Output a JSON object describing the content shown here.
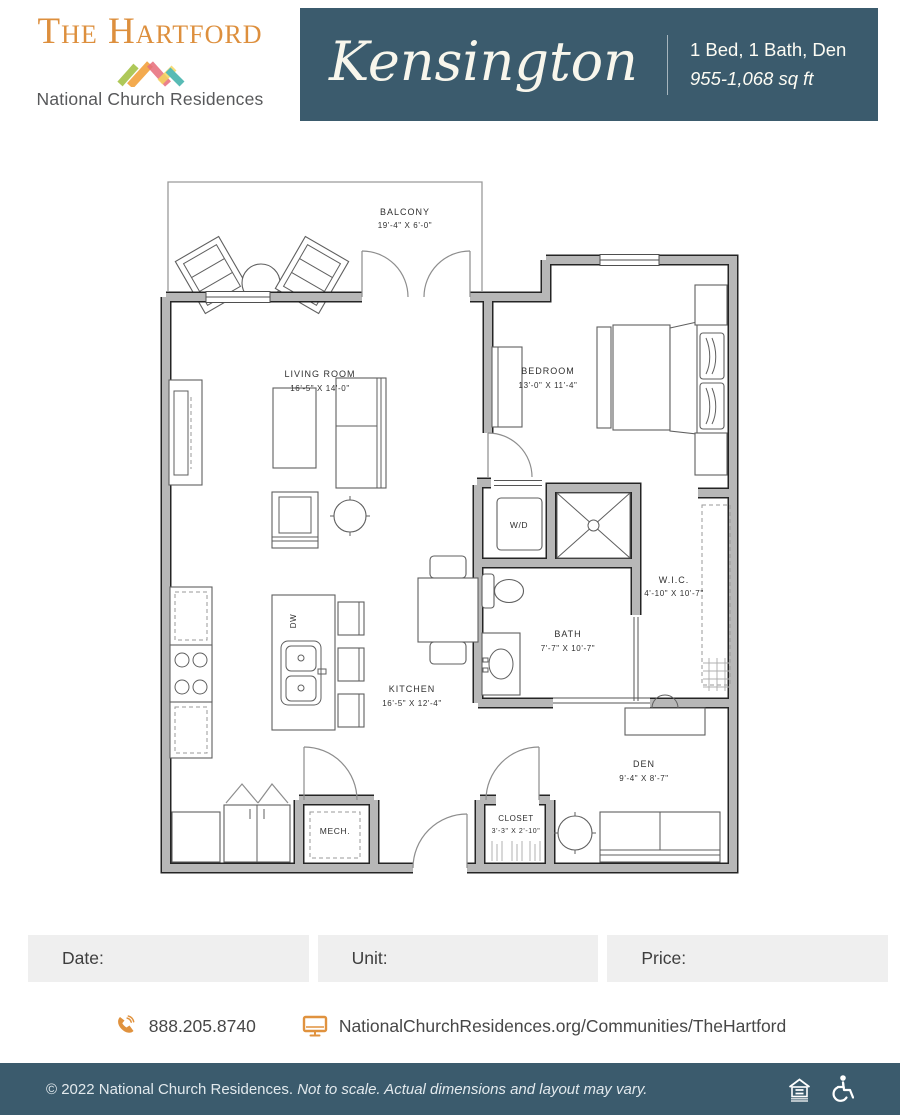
{
  "brand": {
    "name": "The Hartford",
    "org": "National Church Residences"
  },
  "plan": {
    "name": "Kensington",
    "type": "1 Bed, 1 Bath, Den",
    "sqft": "955-1,068 sq ft"
  },
  "floorplan": {
    "rooms": {
      "balcony": {
        "label": "BALCONY",
        "dims": "19'-4\" X 6'-0\""
      },
      "living": {
        "label": "LIVING ROOM",
        "dims": "16'-5\" X 14'-0\""
      },
      "bedroom": {
        "label": "BEDROOM",
        "dims": "13'-0\" X 11'-4\""
      },
      "kitchen": {
        "label": "KITCHEN",
        "dims": "16'-5\" X 12'-4\""
      },
      "bath": {
        "label": "BATH",
        "dims": "7'-7\" X 10'-7\""
      },
      "wic": {
        "label": "W.I.C.",
        "dims": "4'-10\" X 10'-7\""
      },
      "den": {
        "label": "DEN",
        "dims": "9'-4\" X 8'-7\""
      },
      "closet": {
        "label": "CLOSET",
        "dims": "3'-3\" X 2'-10\""
      },
      "wd": {
        "label": "W/D"
      },
      "dw": {
        "label": "DW"
      },
      "mech": {
        "label": "MECH."
      }
    }
  },
  "fields": {
    "date": "Date:",
    "unit": "Unit:",
    "price": "Price:"
  },
  "contact": {
    "phone": "888.205.8740",
    "website": "NationalChurchResidences.org/Communities/TheHartford"
  },
  "footer": {
    "copyright": "© 2022 National Church Residences.",
    "disclaimer": "Not to scale. Actual dimensions and layout may vary."
  },
  "colors": {
    "teal": "#3b5b6d",
    "orange": "#dd8f3d",
    "field_gray": "#efefef"
  }
}
